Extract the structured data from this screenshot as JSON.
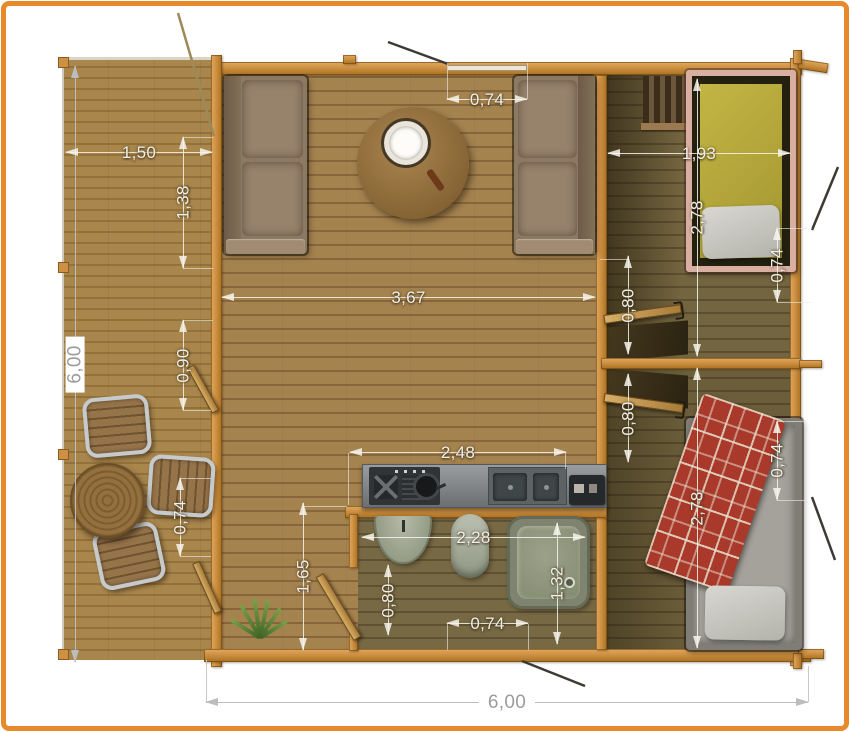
{
  "plan": {
    "kind": "cabin floor plan, top view",
    "units": "meters"
  },
  "colors": {
    "frame": "#E8892C",
    "wall": "#CE9143",
    "wall_hi": "#E0A85C",
    "wall_lo": "#A9701F",
    "deck_a": "#A8864C",
    "deck_b": "#93713A",
    "living_a": "#A5834F",
    "living_b": "#87663C",
    "hall_a": "#73653F",
    "hall_b": "#5C4E2F",
    "bath_a": "#776944",
    "bath_b": "#5F5233",
    "dim_light": "#F2EFE6",
    "dim_gray": "#9C9C9C",
    "sofa": "#8D7863",
    "bed1_frame": "#D9AFA2",
    "bed2_blanket": "#A93A2B"
  },
  "dims": {
    "total_height": "6,00",
    "total_width": "6,00",
    "porch_width": "1,50",
    "porch_opening_upper": "1,38",
    "porch_opening_middle": "0,90",
    "porch_window": "0,74",
    "front_window": "0,74",
    "living_width": "3,67",
    "counter_width": "2,48",
    "bathroom_width": "2,28",
    "bathroom_door": "0,80",
    "bathroom_depth": "1,65",
    "shower_width": "1,32",
    "bathroom_window": "0,74",
    "hall_door_upper": "0,80",
    "hall_door_lower": "0,80",
    "bedroom1_width": "1,93",
    "bedroom1_depth": "2,78",
    "bedroom1_window": "0,74",
    "bedroom2_depth": "2,78",
    "bedroom2_window": "0,74"
  }
}
